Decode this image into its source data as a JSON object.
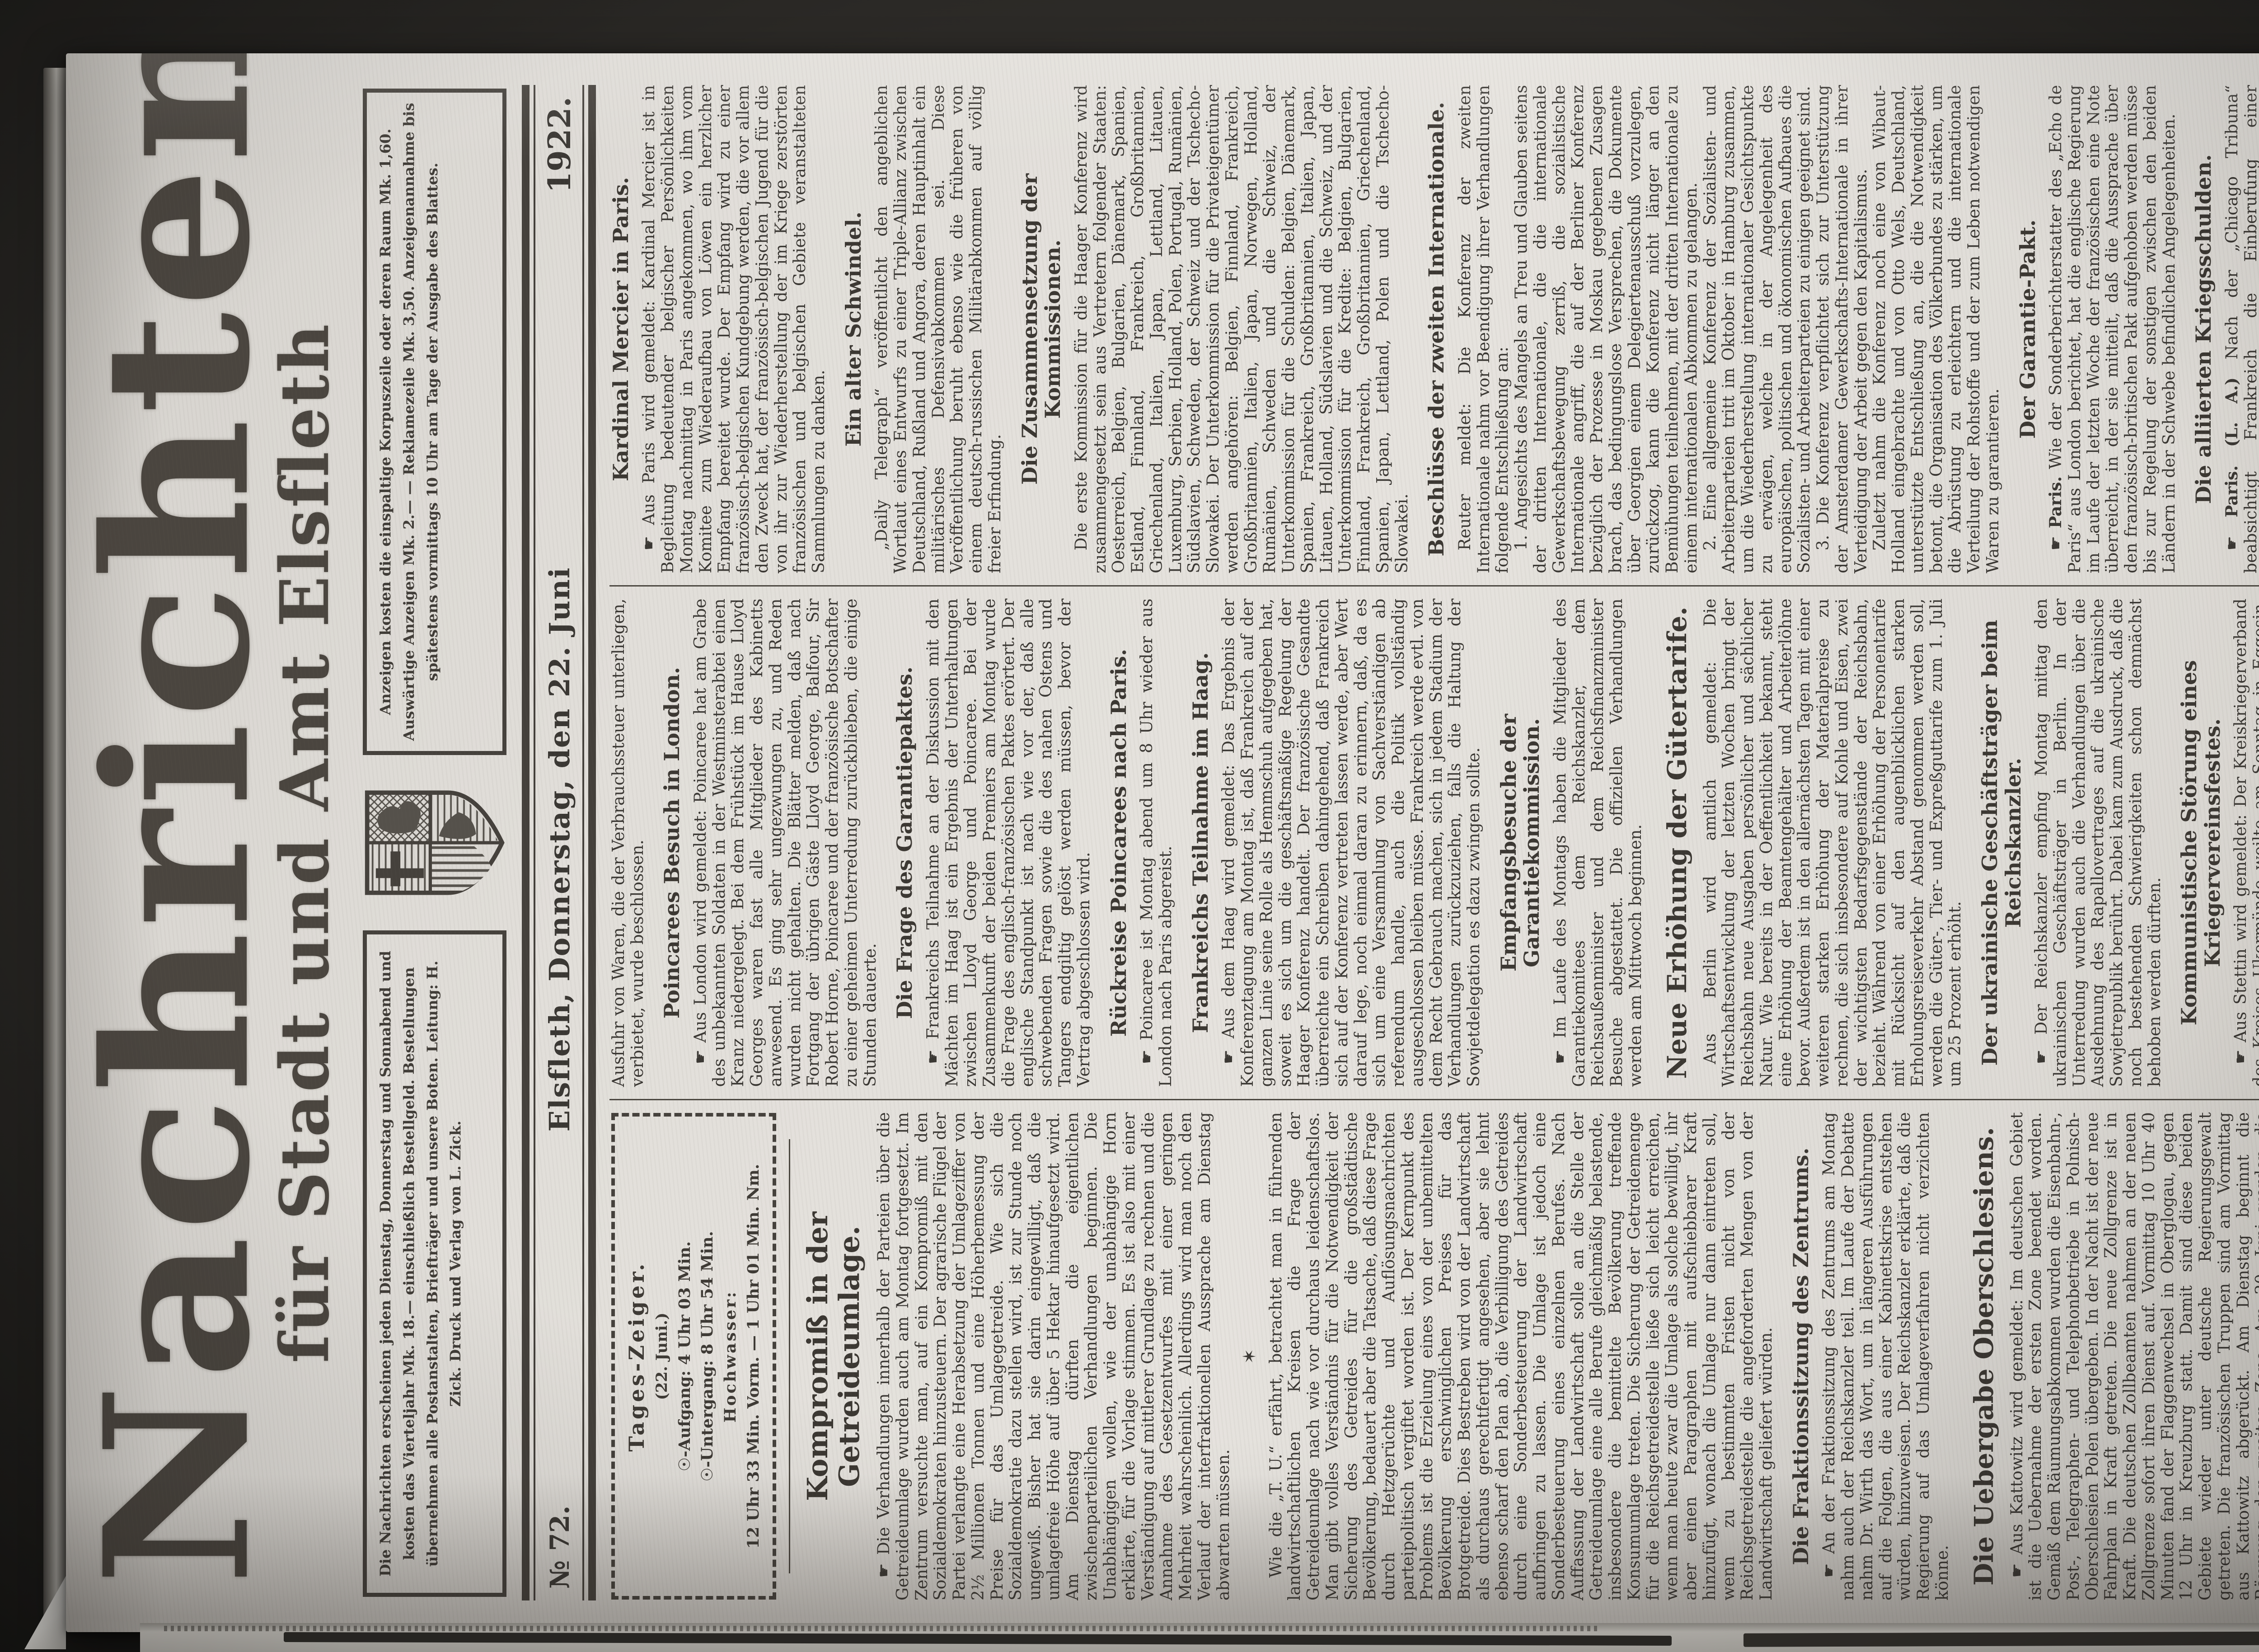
{
  "masthead": {
    "title": "Nachrichten",
    "subtitle": "für Stadt und Amt Elsfleth",
    "publication_lines": "Die Nachrichten erscheinen jeden Dienstag, Donnerstag und Sonnabend und kosten das Vierteljahr Mk. 18.— einschließlich Bestellgeld. Bestellungen übernehmen alle Postanstalten, Briefträger und unsere Boten. Leitung: H. Zick. Druck und Verlag von L. Zick.",
    "ad_lines": "Anzeigen kosten die einspaltige Korpuszeile oder deren Raum Mk. 1,60. Auswärtige Anzeigen Mk. 2.— — Reklamezeile Mk. 3,50. Anzeigenannahme bis spätestens vormittags 10 Uhr am Tage der Ausgabe des Blattes."
  },
  "dateline": {
    "issue": "№ 72.",
    "place_date": "Elsfleth, Donnerstag, den 22. Juni",
    "year": "1922."
  },
  "almanac": {
    "title": "Tages-Zeiger.",
    "date": "(22. Juni.)",
    "sunrise": "☉-Aufgang: 4 Uhr 03 Min.",
    "sunset": "☉-Untergang: 8 Uhr 54 Min.",
    "tide_label": "Hochwasser:",
    "tide_times": "12 Uhr 33 Min. Vorm. — 1 Uhr 01 Min. Nm."
  },
  "articles": [
    {
      "kind": "headline-xl",
      "text": "Kompromiß in der Getreideumlage."
    },
    {
      "kind": "p",
      "text": "☛ Die Verhandlungen innerhalb der Parteien über die Getreideumlage wurden auch am Montag fortgesetzt. Im Zentrum versuchte man, auf ein Kompromiß mit den Sozialdemokraten hinzusteuern. Der agrarische Flügel der Partei verlangte eine Herabsetzung der Umlageziffer von 2½ Millionen Tonnen und eine Höherbemessung der Preise für das Umlagegetreide. Wie sich die Sozialdemokratie dazu stellen wird, ist zur Stunde noch ungewiß. Bisher hat sie darin eingewilligt, daß die umlagefreie Höhe auf über 5 Hektar hinaufgesetzt wird. Am Dienstag dürften die eigentlichen zwischenparteilichen Verhandlungen beginnen. Die Unabhängigen wollen, wie der unabhängige Horn erklärte, für die Vorlage stimmen. Es ist also mit einer Verständigung auf mittlerer Grundlage zu rechnen und die Annahme des Gesetzentwurfes mit einer geringen Mehrheit wahrscheinlich. Allerdings wird man noch den Verlauf der interfraktionellen Aussprache am Dienstag abwarten müssen."
    },
    {
      "kind": "divider",
      "text": "✶"
    },
    {
      "kind": "p",
      "text": "Wie die „T. U.“ erfährt, betrachtet man in führenden landwirtschaftlichen Kreisen die Frage der Getreideumlage nach wie vor durchaus leidenschaftslos. Man gibt volles Verständnis für die Notwendigkeit der Sicherung des Getreides für die großstädtische Bevölkerung, bedauert aber die Tatsache, daß diese Frage durch Hetzgerüchte und Auflösungsnachrichten parteipolitisch vergiftet worden ist. Der Kernpunkt des Problems ist die Erzielung eines von der unbemittelten Bevölkerung erschwinglichen Preises für das Brotgetreide. Dies Bestreben wird von der Landwirtschaft als durchaus gerechtfertigt angesehen, aber sie lehnt ebenso scharf den Plan ab, die Verbilligung des Getreides durch eine Sonderbesteuerung der Landwirtschaft aufbringen zu lassen. Die Umlage ist jedoch eine Sonderbesteuerung eines einzelnen Berufes. Nach Auffassung der Landwirtschaft solle an die Stelle der Getreideumlage eine alle Berufe gleichmäßig belastende, insbesondere die bemittelte Bevölkerung treffende Konsumumlage treten. Die Sicherung der Getreidemenge für die Reichsgetreidestelle ließe sich leicht erreichen, wenn man heute zwar die Umlage als solche bewilligt, ihr aber einen Paragraphen mit aufschiebbarer Kraft hinzufügt, wonach die Umlage nur dann eintreten soll, wenn zu bestimmten Fristen nicht von der Reichsgetreidestelle die angeforderten Mengen von der Landwirtschaft geliefert würden."
    },
    {
      "kind": "headline",
      "text": "Die Fraktionssitzung des Zentrums."
    },
    {
      "kind": "p",
      "text": "☛ An der Fraktionssitzung des Zentrums am Montag nahm auch der Reichskanzler teil. Im Laufe der Debatte nahm Dr. Wirth das Wort, um in längeren Ausführungen auf die Folgen, die aus einer Kabinettskrise entstehen würden, hinzuweisen. Der Reichskanzler erklärte, daß die Regierung auf das Umlageverfahren nicht verzichten könne."
    },
    {
      "kind": "headline-lg",
      "text": "Die Uebergabe Oberschlesiens."
    },
    {
      "kind": "p",
      "text": "☛ Aus Kattowitz wird gemeldet: Im deutschen Gebiet ist die Uebernahme der ersten Zone beendet worden. Gemäß dem Räumungsabkommen wurden die Eisenbahn-, Post-, Telegraphen- und Telephonbetriebe in Polnisch-Oberschlesien Polen übergeben. In der Nacht ist der neue Fahrplan in Kraft getreten. Die neue Zollgrenze ist in Kraft. Die deutschen Zollbeamten nahmen an der neuen Zollgrenze sofort ihren Dienst auf. Vormittag 10 Uhr 40 Minuten fand der Flaggenwechsel in Oberglogau, gegen 12 Uhr in Kreuzburg statt. Damit sind diese beiden Gebiete wieder unter deutsche Regierungsgewalt getreten. Die französischen Truppen sind am Vormittag aus Kattowitz abgerückt. Am Dienstag beginnt die Räumung der zweiten Zone. Am 20. Juni werden die Abstimmungspolizei und die Gemeindewachen aufgelöst. Am 21. Juni erfolgt der Einmarsch deutscher bezw. polnischer Truppen in Leobschütz bezw. Königshütte. Am 22. Juni werden diese Gebiete von den interalliierten Truppen verlassen. Im vorläufigen Woiwodschaftsrat in Kattowitz legte der Vorsitzende eine Verordnung vor, die die Ausfuhr von Gegenständen des täglichen Bedarfs verbietet. Nach einer längeren Erörterung wurde die Verordnung angenommen. Auch eine Verordnung, die die Ausfuhr von Waren, die der Verbrauchssteuer unterliegen, verbietet, wurde beschlossen."
    },
    {
      "kind": "headline",
      "text": "Poincarees Besuch in London."
    },
    {
      "kind": "p",
      "text": "☛ Aus London wird gemeldet: Poincaree hat am Grabe des unbekannten Soldaten in der Westminsterabtei einen Kranz niedergelegt. Bei dem Frühstück im Hause Lloyd Georges waren fast alle Mitglieder des Kabinetts anwesend. Es ging sehr ungezwungen zu, und Reden wurden nicht gehalten. Die Blätter melden, daß nach Fortgang der übrigen Gäste Lloyd George, Balfour, Sir Robert Horne, Poincaree und der französische Botschafter zu einer geheimen Unterredung zurückblieben, die einige Stunden dauerte."
    },
    {
      "kind": "headline",
      "text": "Die Frage des Garantiepaktes."
    },
    {
      "kind": "p",
      "text": "☛ Frankreichs Teilnahme an der Diskussion mit den Mächten im Haag ist ein Ergebnis der Unterhaltungen zwischen Lloyd George und Poincaree. Bei der Zusammenkunft der beiden Premiers am Montag wurde die Frage des englisch-französischen Paktes erörtert. Der englische Standpunkt ist nach wie vor der, daß alle schwebenden Fragen sowie die des nahen Ostens und Tangers endgiltig gelöst werden müssen, bevor der Vertrag abgeschlossen wird."
    },
    {
      "kind": "headline",
      "text": "Rückreise Poincarees nach Paris."
    },
    {
      "kind": "p",
      "text": "☛ Poincaree ist Montag abend um 8 Uhr wieder aus London nach Paris abgereist."
    },
    {
      "kind": "headline",
      "text": "Frankreichs Teilnahme im Haag."
    },
    {
      "kind": "p",
      "text": "☛ Aus dem Haag wird gemeldet: Das Ergebnis der Konferenztagung am Montag ist, daß Frankreich auf der ganzen Linie seine Rolle als Hemmschuh aufgegeben hat, soweit es sich um die geschäftsmäßige Regelung der Haager Konferenz handelt. Der französische Gesandte überreichte ein Schreiben dahingehend, daß Frankreich sich auf der Konferenz vertreten lassen werde, aber Wert darauf lege, noch einmal daran zu erinnern, daß, da es sich um eine Versammlung von Sachverständigen ab referendum handle, auch die Politik vollständig ausgeschlossen bleiben müsse. Frankreich werde evtl. von dem Recht Gebrauch machen, sich in jedem Stadium der Verhandlungen zurückzuziehen, falls die Haltung der Sowjetdelegation es dazu zwingen sollte."
    },
    {
      "kind": "headline",
      "text": "Empfangsbesuche der Garantiekommission."
    },
    {
      "kind": "p",
      "text": "☛ Im Laufe des Montags haben die Mitglieder des Garantiekomitees dem Reichskanzler, dem Reichsaußenminister und dem Reichsfinanzminister Besuche abgestattet. Die offiziellen Verhandlungen werden am Mittwoch beginnen."
    },
    {
      "kind": "headline-lg",
      "text": "Neue Erhöhung der Gütertarife."
    },
    {
      "kind": "p",
      "text": "Aus Berlin wird amtlich gemeldet: Die Wirtschaftsentwicklung der letzten Wochen bringt der Reichsbahn neue Ausgaben persönlicher und sächlicher Natur. Wie bereits in der Oeffentlichkeit bekannt, steht eine Erhöhung der Beamtengehälter und Arbeiterlöhne bevor. Außerdem ist in den allernächsten Tagen mit einer weiteren starken Erhöhung der Materialpreise zu rechnen, die sich insbesondere auf Kohle und Eisen, zwei der wichtigsten Bedarfsgegenstände der Reichsbahn, bezieht. Während von einer Erhöhung der Personentarife mit Rücksicht auf den augenblicklichen starken Erholungsreiseverkehr Abstand genommen werden soll, werden die Güter-, Tier- und Expreßguttarife zum 1. Juli um 25 Prozent erhöht."
    },
    {
      "kind": "headline",
      "text": "Der ukrainische Geschäftsträger beim Reichskanzler."
    },
    {
      "kind": "p",
      "text": "☛ Der Reichskanzler empfing Montag mittag den ukrainischen Geschäftsträger in Berlin. In der Unterredung wurden auch die Verhandlungen über die Ausdehnung des Rapallovertrages auf die ukrainische Sowjetrepublik berührt. Dabei kam zum Ausdruck, daß die noch bestehenden Schwierigkeiten schon demnächst behoben werden dürften."
    },
    {
      "kind": "headline",
      "text": "Kommunistische Störung eines Kriegervereinsfestes."
    },
    {
      "kind": "p",
      "text": "☛ Aus Stettin wird gemeldet: Der Kreiskriegerverband des Kreises Ukermünde weilte am Sonntag in Eggesin. Nach dem Gottesdienst, dem auch Generalfeldmarschall von Mackensen beiwohnte, versammelten sich etwa 150 Kommunisten aus den umliegenden Ortschaften. Sie brachten Hochrufe auf die Revolution aus und versuchten, nach dem Auto des Generalfeldmarschalls vorzudringen. Es wurden Schmährufe gegen den Generalfeldmarschall laut. Darauf kam es zum Handgemenge, wobei mit Stöcken geschlagen wurde. Die Feldjäger machten von ihrer Waffe Gebrauch. Die Kommunisten wurden schließlich in die Flucht geschlagen."
    },
    {
      "kind": "headline",
      "text": "Kardinal Mercier in Paris."
    },
    {
      "kind": "p",
      "text": "☛ Aus Paris wird gemeldet: Kardinal Mercier ist in Begleitung bedeutender belgischer Persönlichkeiten Montag nachmittag in Paris angekommen, wo ihm vom Komitee zum Wiederaufbau von Löwen ein herzlicher Empfang bereitet wurde. Der Empfang wird zu einer französisch-belgischen Kundgebung werden, die vor allem den Zweck hat, der französisch-belgischen Jugend für die von ihr zur Wiederherstellung der im Kriege zerstörten französischen und belgischen Gebiete veranstalteten Sammlungen zu danken."
    },
    {
      "kind": "headline",
      "text": "Ein alter Schwindel."
    },
    {
      "kind": "p",
      "text": "„Daily Telegraph“ veröffentlicht den angeblichen Wortlaut eines Entwurfs zu einer Triple-Allianz zwischen Deutschland, Rußland und Angora, deren Hauptinhalt ein militärisches Defensivabkommen sei. Diese Veröffentlichung beruht ebenso wie die früheren von einem deutsch-russischen Militärabkommen auf völlig freier Erfindung."
    },
    {
      "kind": "headline",
      "text": "Die Zusammensetzung der Kommissionen."
    },
    {
      "kind": "p",
      "text": "Die erste Kommission für die Haager Konferenz wird zusammengesetzt sein aus Vertretern folgender Staaten: Oesterreich, Belgien, Bulgarien, Dänemark, Spanien, Estland, Finnland, Frankreich, Großbritannien, Griechenland, Italien, Japan, Lettland, Litauen, Luxemburg, Serbien, Holland, Polen, Portugal, Rumänien, Südslavien, Schweden, der Schweiz und der Tschecho-Slowakei. Der Unterkommission für die Privateigentümer werden angehören: Belgien, Finnland, Frankreich, Großbritannien, Italien, Japan, Norwegen, Holland, Rumänien, Schweden und die Schweiz, der Unterkommission für die Schulden: Belgien, Dänemark, Spanien, Frankreich, Großbritannien, Italien, Japan, Litauen, Holland, Südslavien und die Schweiz, und der Unterkommission für die Kredite: Belgien, Bulgarien, Finnland, Frankreich, Großbritannien, Griechenland, Spanien, Japan, Lettland, Polen und die Tschecho-Slowakei."
    },
    {
      "kind": "headline",
      "text": "Beschlüsse der zweiten Internationale."
    },
    {
      "kind": "p",
      "text": "Reuter meldet: Die Konferenz der zweiten Internationale nahm vor Beendigung ihrer Verhandlungen folgende Entschließung an:"
    },
    {
      "kind": "p",
      "text": "1. Angesichts des Mangels an Treu und Glauben seitens der dritten Internationale, die die internationale Gewerkschaftsbewegung zerriß, die sozialistische Internationale angriff, die auf der Berliner Konferenz bezüglich der Prozesse in Moskau gegebenen Zusagen brach, das bedingungslose Versprechen, die Dokumente über Georgien einem Delegiertenausschuß vorzulegen, zurückzog, kann die Konferenz nicht länger an den Bemühungen teilnehmen, mit der dritten Internationale zu einem internationalen Abkommen zu gelangen."
    },
    {
      "kind": "p",
      "text": "2. Eine allgemeine Konferenz der Sozialisten- und Arbeiterparteien tritt im Oktober in Hamburg zusammen, um die Wiederherstellung internationaler Gesichtspunkte zu erwägen, welche in der Angelegenheit des europäischen, politischen und ökonomischen Aufbaues die Sozialisten- und Arbeiterparteien zu einigen geeignet sind."
    },
    {
      "kind": "p",
      "text": "3. Die Konferenz verpflichtet sich zur Unterstützung der Amsterdamer Gewerkschafts-Internationale in ihrer Verteidigung der Arbeit gegen den Kapitalismus."
    },
    {
      "kind": "p",
      "text": "Zuletzt nahm die Konferenz noch eine von Wibaut-Holland eingebrachte und von Otto Wels, Deutschland, unterstützte Entschließung an, die die Notwendigkeit betont, die Organisation des Völkerbundes zu stärken, um die Abrüstung zu erleichtern und die internationale Verteilung der Rohstoffe und der zum Leben notwendigen Waren zu garantieren."
    },
    {
      "kind": "headline",
      "text": "Der Garantie-Pakt."
    },
    {
      "kind": "p",
      "lead": "☛ Paris.",
      "text": "Wie der Sonderberichterstatter des „Echo de Paris“ aus London berichtet, hat die englische Regierung im Laufe der letzten Woche der französischen eine Note überreicht, in der sie mitteilt, daß die Aussprache über den französisch-britischen Pakt aufgehoben werden müsse bis zur Regelung der sonstigen zwischen den beiden Ländern in der Schwebe befindlichen Angelegenheiten."
    },
    {
      "kind": "headline",
      "text": "Die alliierten Kriegsschulden."
    },
    {
      "kind": "p",
      "lead": "☛ Paris. (L. A.)",
      "text": "Nach der „Chicago Tribuna“ beabsichtigt Frankreich die Einberufung einer internationalen Konferenz für die Aufhebung der Schulden aus der Kriegszeit."
    },
    {
      "kind": "headline",
      "text": "Störung einer nationalen Feier."
    },
    {
      "kind": "p",
      "lead": "☛ Chemnitz. (L. A.)",
      "text": "Eine von nationalen Verbänden veranstaltete Sonnenwendfeier wurde von Kommunisten gestört. Es kam zu einer Schlägerei, bei der zehn Personen erheblich verletzt wurden."
    },
    {
      "kind": "headline",
      "text": "Rückgabe des deutschen Eigentums in Amerika."
    },
    {
      "kind": "p",
      "lead": "☛ Washington. (E. A.)",
      "text": "Die amerikanische Regierung arbeitet einen Plan zur Rückerstattung des sequestrierten deutschen Eigentums aus."
    },
    {
      "kind": "headline",
      "text": "Die Gründung der österreichischen Notenbank."
    },
    {
      "kind": "p",
      "lead": "☛ Wien.",
      "text": "Die Regierung läßt halbamtlich bekannt geben, daß das Zustandekommen der neuen Notenbank nach den beschlossenen Abmachungen bereits gesichert sei. Über das Statut, die Aufbringung der nötigen Mittel, die Aufteilung an die Teilhaber wird noch verhandelt. Der günstige Verlauf dieser Verhandlungen stelle die befriedigende Deckung der Noten der österreichisch-ungarischen Bank in Aussicht. Die Regierung plane auch, die Devisenbestände Privater zur Gründung der Notenbank heranzuziehen, und zwar unter Verzicht auf Zwangsmaßnahmen. Als Anreiz zur Zeichnung von Aktien der neuen Notenbank dient u. a. die Zusage der Verzinsung der auf Gold lautenden Aktien in Gold. Auch soll den Privatzeichnern glaubhaft nachgewiesen werden, daß gezeichnete Devisen nicht verloren gehen. Es liegen auch Mitteilungen ausschlaggebender Organisationen, namentlich des Bauernbundes, vor, aus deren Bereitwilligkeit hervorgeht, auch ihre Devisenbestände zur Zeichnung von Aktien der neuen Notenbank zu benutzen. Neben den Verhandlungen über das Stammkapital der neuen Bank wird weiter eifrig an der Abfassung des Finanzplanes gearbeitet, der die Herstellung des Gleichgewichts des Staatshaushalts zum Ziele hat und am Mittwoch dem Nationalrat vorgelegt werden soll. Er soll auch als Grundlage für die Verhandlungen über den ausländischen Kredit dienen."
    },
    {
      "kind": "headline-section",
      "text": "Politische Nachrichten."
    },
    {
      "kind": "p",
      "lead": "Wiederaufnahme der Verhandlungen um Groß-Hamburg.",
      "text": "Die Verhandlungen um Groß-Hamburg sind wieder aufgenommen worden. Als preußische Verhandlungskommission trafen in Hamburg ein Staatsminister a. D. Dr. Südekum, Staatssekretär Göhre, Staatssekretär Dr. Freund, Ministerialdirektor von Loebell, Ministerialrat Dr. Stühler und Geheimer Regierungsrat Jacques."
    },
    {
      "kind": "p",
      "lead": "Die Wucherbekämpfung vor dem bayerischen Landtag.",
      "text": "In dem Unterausschuß des bayerischen Landtages zur Wucherbekämpfung äußerte sich der Vertreter des bayerischen Städtebundes Dr. Knorr dahin: äußerster Widerstand gegen die unerschöpflichen Forderungen des Feindbundes, unentwegte Bekämpfung der Kriegsschuldlüge, Revision des Versailler Vertrages, Schließung des Loches im Westen, Ueberwachung der Luxuseinfuhr, Einfuhr von lebensnotwendigen Artikeln, besonders aus den valutaschwachen Ländern, Umwandlung des schematischen Achtstundentages in den normalen Achtstundentag, Förderung des Gemeinsamkeitsgeistes, besondere Hilfe für diejenigen, die durch die Kriegsnöte in schwerste Bedrängnis geraten sind. Der Vertreter des bayerischen Beamtenbundes Dr. Waldmann verlangt u. a. die Ausweisung von Ausländern, die schädliche Glieder des Handels geworden seien, ferner kräftige Erfassung der Ueberschiffe durch Steuern."
    }
  ]
}
